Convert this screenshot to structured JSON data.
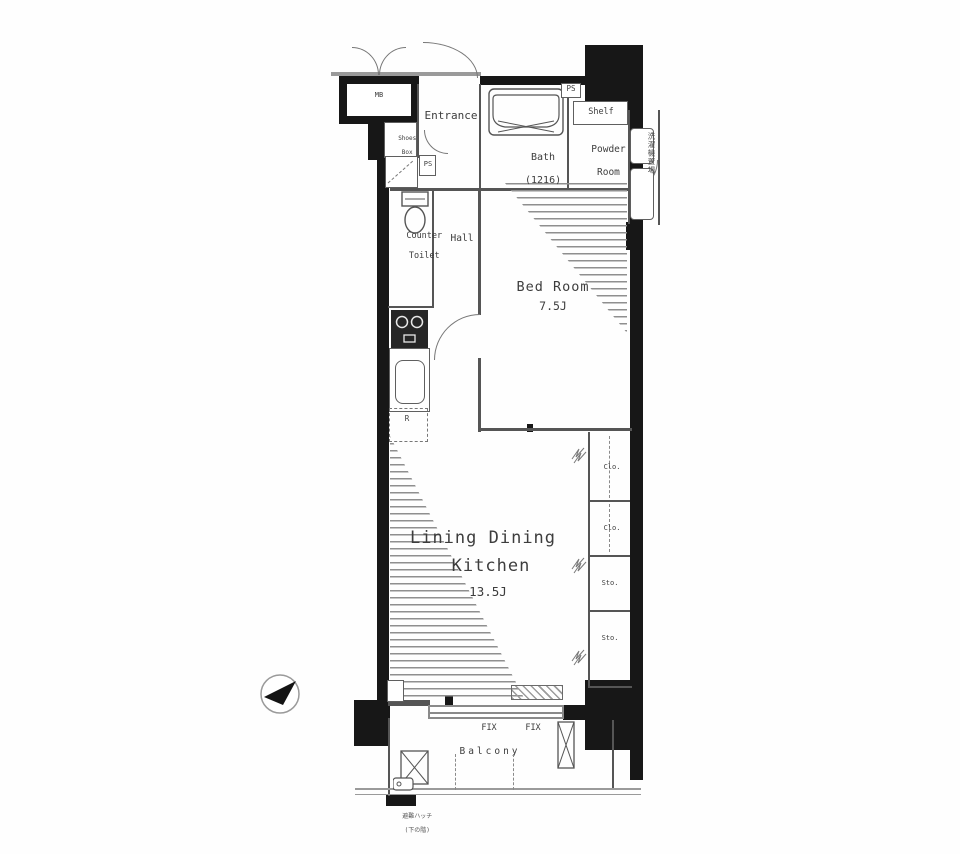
{
  "colors": {
    "wall": "#171717",
    "thin_line": "#555555",
    "text": "#3d3d3d",
    "hatch_stripe": "#8f8f8f"
  },
  "floorplan": {
    "mb": "MB",
    "entrance": "Entrance",
    "shoes_box": {
      "l1": "Shoes",
      "l2": "Box"
    },
    "bath": {
      "name": "Bath",
      "size": "(1216)"
    },
    "ps_bath": "PS",
    "shelf": "Shelf",
    "powder": {
      "l1": "Powder",
      "l2": "Room"
    },
    "laundry_vertical": "洗濯機置場",
    "ps_toilet": "PS",
    "toilet": {
      "l1": "Counter",
      "l2": "Toilet"
    },
    "hall": "Hall",
    "bedroom": {
      "name": "Bed Room",
      "size": "7.5J"
    },
    "refrigerator": "R",
    "ldk": {
      "l1": "Lining Dining",
      "l2": "Kitchen",
      "size": "13.5J"
    },
    "closets": [
      "Clo.",
      "Clo.",
      "Sto.",
      "Sto."
    ],
    "windows": {
      "fix1": "FIX",
      "fix2": "FIX"
    },
    "balcony": "Balcony",
    "hatch_note": {
      "l1": "避難ハッチ",
      "l2": "(下の階)"
    }
  }
}
